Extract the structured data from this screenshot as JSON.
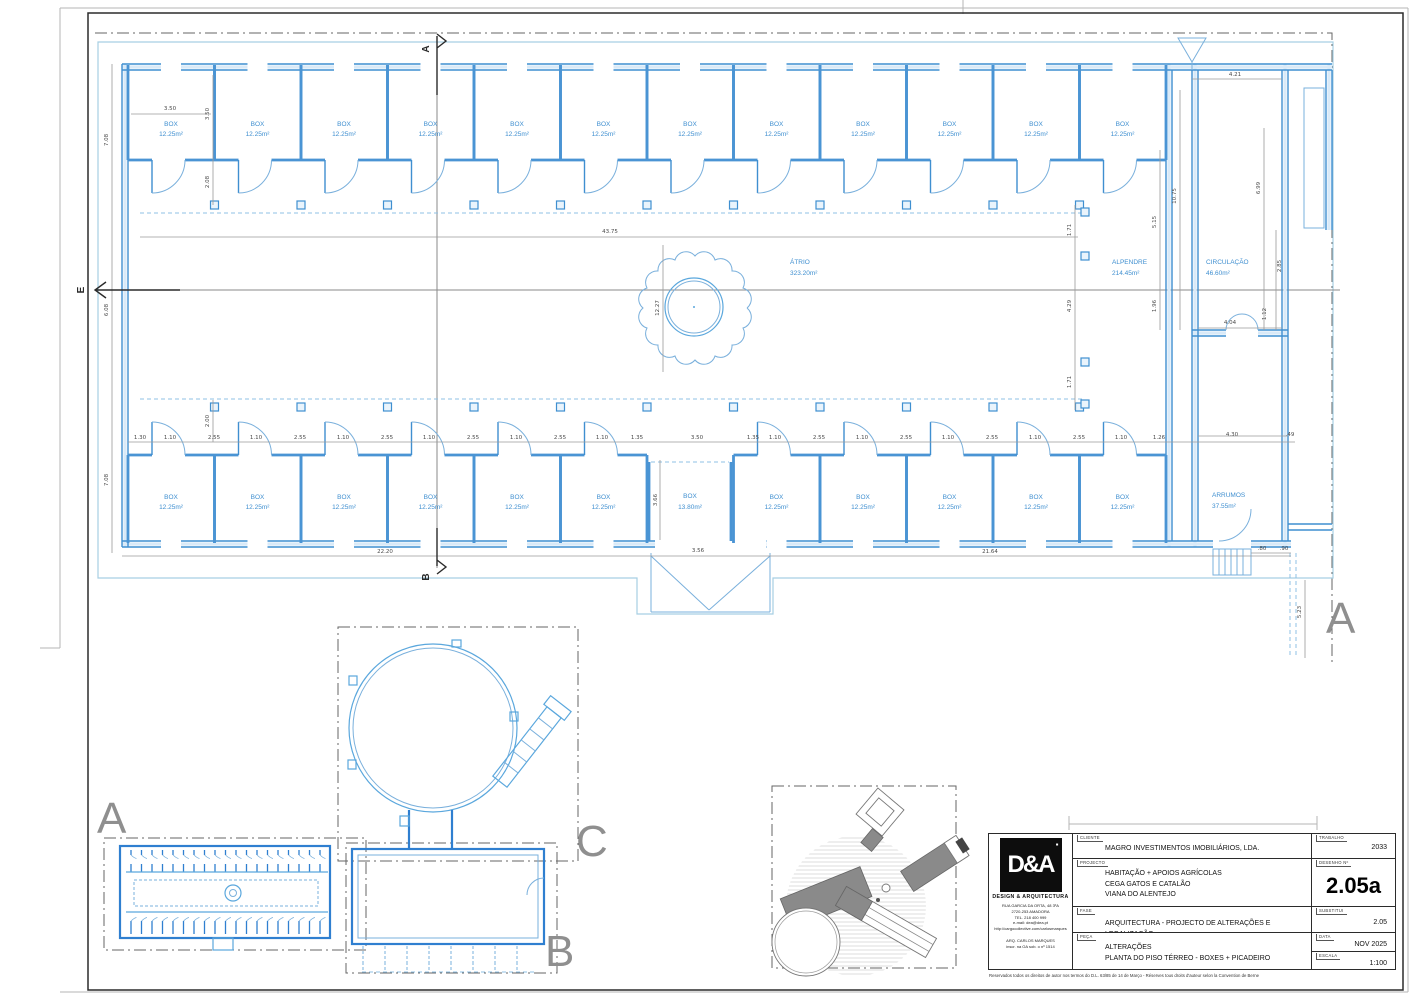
{
  "plan": {
    "rooms": {
      "box": {
        "name": "BOX",
        "area": "12.25m²"
      },
      "box_large": {
        "name": "BOX",
        "area": "13.80m²"
      },
      "atrio": {
        "name": "ÁTRIO",
        "area": "323.20m²"
      },
      "alpendre": {
        "name": "ALPENDRE",
        "area": "214.45m²"
      },
      "circulacao": {
        "name": "CIRCULAÇÃO",
        "area": "46.60m²"
      },
      "arrumos": {
        "name": "ARRUMOS",
        "area": "37.55m²"
      }
    },
    "letters": {
      "a": "A",
      "b": "B",
      "c": "C",
      "e": "E"
    },
    "dims": {
      "d130": "1.30",
      "d110": "1.10",
      "d255": "2.55",
      "d135": "1.35",
      "d350": "3.50",
      "d208": "2.08",
      "d200": "2.00",
      "d708": "7.08",
      "d608": "6.08",
      "d4375": "43.75",
      "d1227": "12.27",
      "d171": "1.71",
      "d429": "4.29",
      "d515": "5.15",
      "d196": "1.96",
      "d1075": "10.75",
      "d421": "4.21",
      "d699": "6.99",
      "d285": "2.85",
      "d112": "1.12",
      "d404": "4.04",
      "d2220": "22.20",
      "d2164": "21.64",
      "d356": "3.56",
      "d430": "4.30",
      "d049": ".49",
      "d080": ".80",
      "d090": ".90",
      "d523": "5.23",
      "d126": "1.26",
      "d366": "3.66"
    }
  },
  "titleblock": {
    "labels": {
      "cliente": "CLIENTE",
      "projecto": "PROJECTO",
      "fase": "FASE",
      "peca": "PEÇA",
      "trabalho": "TRABALHO",
      "desenho": "DESENHO Nº",
      "substitui": "SUBSTITUI",
      "data": "DATA",
      "escala": "ESCALA"
    },
    "cliente": "MAGRO INVESTIMENTOS IMOBILIÁRIOS, LDA.",
    "projecto_lines": [
      "HABITAÇÃO + APOIOS AGRÍCOLAS",
      "CEGA GATOS E CATALÃO",
      "VIANA DO ALENTEJO"
    ],
    "fase": "ARQUITECTURA - PROJECTO DE ALTERAÇÕES E LEGALIZAÇÃO",
    "peca_lines": [
      "ALTERAÇÕES",
      "PLANTA DO PISO TÉRREO - BOXES + PICADEIRO"
    ],
    "trabalho": "2033",
    "desenho": "2.05a",
    "substitui": "2.05",
    "data": "NOV 2025",
    "escala": "1:100",
    "firm": {
      "logo": "D&A",
      "logo_mark": "▪",
      "name": "DESIGN & ARQUITECTURA",
      "address_lines": [
        "RUA GARCIA DA ORTA, 48 3ºA",
        "2720-253 AMADORA",
        "TEL. 218 400 999",
        "e-mail: dea@dea.pt",
        "http://cargocollective.com/carlosmarques"
      ],
      "architect_lines": [
        "ARQ. CARLOS MARQUES",
        "inscr. na OA sob. o nº 1514"
      ]
    },
    "copyright": "Reservados todos os direitos de autor nos termos do D.L. 63/85 de 14 de Março - Réserves tous droits d'auteur selon la Convention de Berne"
  },
  "colors": {
    "wall_blue": "#3f8fd0",
    "label_blue": "#3f8fd0",
    "grey": "#8f8f8f"
  }
}
